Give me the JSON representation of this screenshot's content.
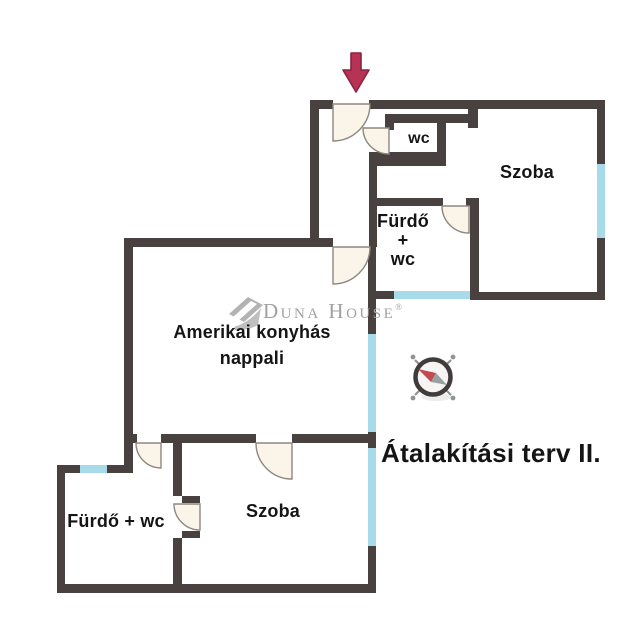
{
  "title": "Átalakítási terv II.",
  "watermark": {
    "brand": "Duna House",
    "registered_mark": "®"
  },
  "rooms": {
    "wc_top": {
      "label": "wc"
    },
    "szoba_top": {
      "label": "Szoba"
    },
    "furdo_wc_middle": {
      "lines": [
        "Fürdő",
        "+",
        "wc"
      ]
    },
    "nappali": {
      "lines": [
        "Amerikai konyhás",
        "nappali"
      ]
    },
    "furdo_wc_bottom": {
      "label": "Fürdő + wc"
    },
    "szoba_bottom": {
      "label": "Szoba"
    }
  },
  "icons": {
    "entrance_arrow": "entrance-arrow-icon",
    "compass": "compass-icon",
    "brand_logo": "duna-house-logo-icon"
  },
  "colors": {
    "wall": "#494140",
    "window": "#a7dbe9",
    "door_fill": "#fbf4e8",
    "door_stroke": "#8e8780",
    "arrow_fill": "#b73355",
    "arrow_stroke": "#8a2240",
    "compass_ring": "#403c3b",
    "compass_face": "#f6f5f3",
    "needle_red": "#c1494f",
    "needle_gray": "#9aa0a2",
    "spoke_gray": "#8f9496",
    "watermark": "#a1a1a1",
    "label": "#151515"
  }
}
